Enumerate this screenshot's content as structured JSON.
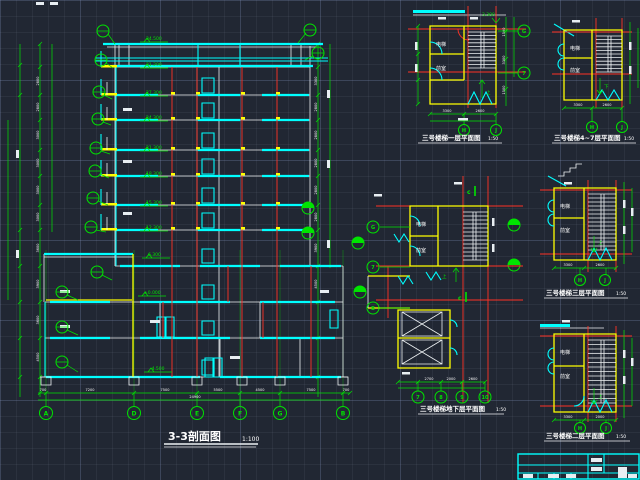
{
  "canvas": {
    "background": "#212733"
  },
  "colors": {
    "cyan": "#00ffff",
    "green": "#00e400",
    "red": "#ff3226",
    "yellow": "#ffff00",
    "white": "#ffffff"
  },
  "section": {
    "title": "3-3剖面图",
    "scale": "1:100",
    "levels": [
      "34.500",
      "31.200",
      "27.300",
      "24.300",
      "21.300",
      "18.300",
      "15.300",
      "12.300",
      "6.300",
      "±0.000",
      "-4.500"
    ],
    "axis_bubbles": [
      "A",
      "D",
      "E",
      "F",
      "G",
      "B"
    ],
    "dims_bottom": [
      "700",
      "7200",
      "7500",
      "5500",
      "4500",
      "7500",
      "700"
    ],
    "dim_total": "24900",
    "left_dims": [
      "2800",
      "2800",
      "3000",
      "3000",
      "3000",
      "3000",
      "3600",
      "3900",
      "3600",
      "4500"
    ],
    "right_dims": [
      "3300",
      "2800",
      "2800",
      "2800",
      "2800",
      "2800",
      "3900",
      "4500"
    ]
  },
  "plans": {
    "p1": {
      "title": "三号楼梯一层平面图",
      "scale": "1:50",
      "room_top": "电梯",
      "room_bottom": "前室",
      "up": "上",
      "level": "3.300",
      "axis_right": [
        "G",
        "7"
      ],
      "axis_bottom": [
        "H",
        "J"
      ],
      "dims_bottom": [
        "3300",
        "2600"
      ],
      "dims_right": [
        "1500",
        "3300",
        "1500"
      ]
    },
    "p2": {
      "title": "三号楼梯4~7层平面图",
      "scale": "1:50",
      "room_top": "电梯",
      "room_bottom": "前室",
      "down": "下",
      "axis_bottom": [
        "H",
        "J"
      ],
      "dims_bottom": [
        "3300",
        "2600"
      ]
    },
    "p3": {
      "title": "三号楼梯三层平面图",
      "scale": "1:50",
      "room_top": "电梯",
      "room_bottom": "前室",
      "up": "上",
      "axis_bottom": [
        "H",
        "J"
      ],
      "dims_bottom": [
        "3300",
        "2600"
      ]
    },
    "p4": {
      "title": "三号楼梯地下层平面图",
      "scale": "1:50",
      "room_top": "电梯",
      "room_bottom": "前室",
      "up": "上",
      "section_mark": "c",
      "axis_left": [
        "G",
        "7",
        "B"
      ],
      "axis_bottom": [
        "7",
        "8",
        "9",
        "10"
      ],
      "dims_bottom": [
        "2700",
        "2000",
        "2600"
      ]
    },
    "p5": {
      "title": "三号楼梯二层平面图",
      "scale": "1:50",
      "room_top": "电梯",
      "room_bottom": "前室",
      "up": "上",
      "axis_bottom": [
        "H",
        "J"
      ],
      "dims_bottom": [
        "3300",
        "2000"
      ]
    }
  }
}
